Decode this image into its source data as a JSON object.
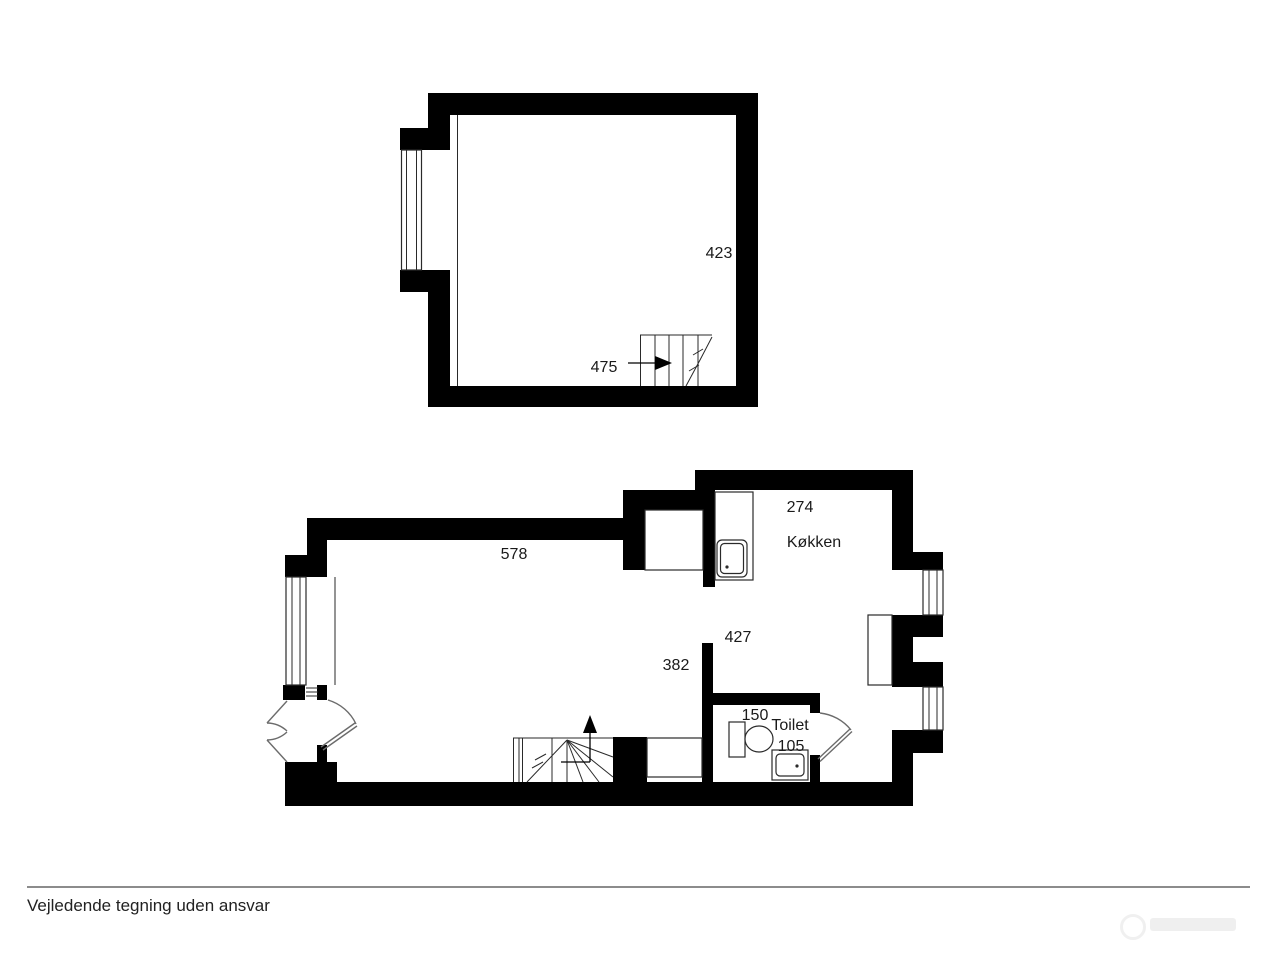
{
  "plans": {
    "upper": {
      "name": "upper-floor-plan",
      "labels": {
        "room_depth": "423",
        "room_width": "475"
      }
    },
    "lower": {
      "name": "ground-floor-plan",
      "labels": {
        "living_width": "578",
        "living_depth": "382",
        "kitchen_width": "274",
        "kitchen_name": "Køkken",
        "hall_depth": "427",
        "toilet_width": "150",
        "toilet_name": "Toilet",
        "toilet_depth": "105"
      }
    }
  },
  "footer": {
    "disclaimer": "Vejledende tegning uden ansvar"
  },
  "colors": {
    "wall": "#000000",
    "text": "#1a1a1a",
    "divider": "#8c8c8c"
  }
}
